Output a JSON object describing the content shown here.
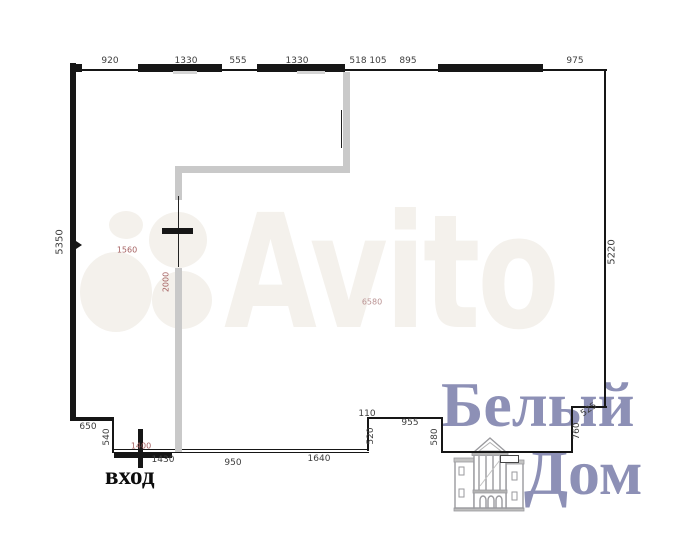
{
  "watermark": {
    "text": "Avito"
  },
  "logo": {
    "line1": "Белый",
    "line2": "Дом",
    "icon": "classical-building-icon"
  },
  "plan": {
    "entrance_label": "вход",
    "dimension_labels": [
      {
        "text": "920",
        "x": 110,
        "y": 61
      },
      {
        "text": "1330",
        "x": 186,
        "y": 61
      },
      {
        "text": "555",
        "x": 238,
        "y": 61
      },
      {
        "text": "1330",
        "x": 297,
        "y": 61
      },
      {
        "text": "518",
        "x": 358,
        "y": 61
      },
      {
        "text": "105",
        "x": 378,
        "y": 61
      },
      {
        "text": "895",
        "x": 408,
        "y": 61
      },
      {
        "text": "975",
        "x": 575,
        "y": 61
      },
      {
        "text": "5350",
        "x": 60,
        "y": 242,
        "rot": -90,
        "size": 10
      },
      {
        "text": "5220",
        "x": 612,
        "y": 252,
        "rot": -90,
        "size": 10
      },
      {
        "text": "650",
        "x": 88,
        "y": 427
      },
      {
        "text": "540",
        "x": 107,
        "y": 437,
        "rot": -90
      },
      {
        "text": "1430",
        "x": 163,
        "y": 460
      },
      {
        "text": "950",
        "x": 233,
        "y": 463
      },
      {
        "text": "1640",
        "x": 319,
        "y": 459
      },
      {
        "text": "110",
        "x": 367,
        "y": 414
      },
      {
        "text": "520",
        "x": 371,
        "y": 436,
        "rot": -90
      },
      {
        "text": "955",
        "x": 410,
        "y": 423
      },
      {
        "text": "580",
        "x": 435,
        "y": 437,
        "rot": -90
      },
      {
        "text": "760",
        "x": 577,
        "y": 431,
        "rot": -90
      },
      {
        "text": "525",
        "x": 589,
        "y": 410,
        "rot": -35
      },
      {
        "text": "1560",
        "x": 127,
        "y": 250,
        "color": "dim_red",
        "size": 8
      },
      {
        "text": "2000",
        "x": 166,
        "y": 282,
        "rot": -90,
        "color": "dim_red",
        "size": 8
      },
      {
        "text": "6580",
        "x": 372,
        "y": 302,
        "color": "dim_red_light",
        "size": 8
      },
      {
        "text": "1400",
        "x": 141,
        "y": 446,
        "color": "dim_red",
        "size": 8
      }
    ]
  },
  "colors": {
    "wall_black": "#161616",
    "wall_gray": "#c9c9c9",
    "watermark": "#f4f1ec",
    "logo_purple": "#8d90b6",
    "dim_dark": "#3d3d3d",
    "dim_red": "#a56060",
    "dim_red_light": "#b99191"
  }
}
